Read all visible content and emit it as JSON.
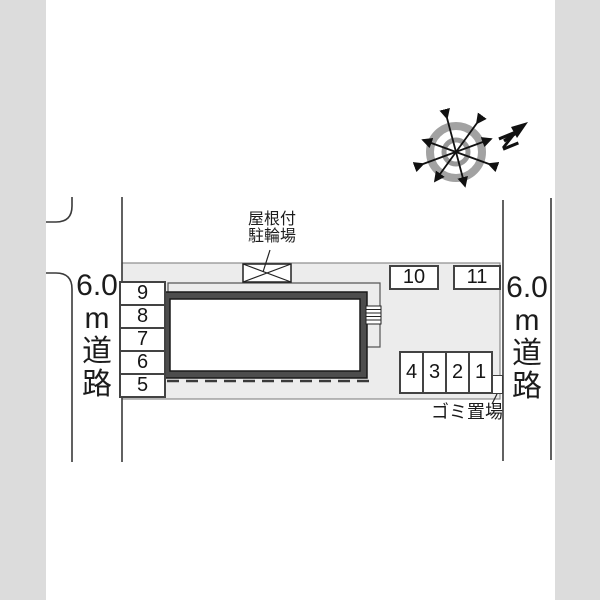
{
  "plan": {
    "roads": {
      "left": {
        "label": "6.0m道路",
        "lines": [
          "6.0",
          "m",
          "道",
          "路"
        ]
      },
      "right": {
        "label": "6.0m道路",
        "lines": [
          "6.0",
          "m",
          "道",
          "路"
        ]
      }
    },
    "bicycle_parking": {
      "label_line1": "屋根付",
      "label_line2": "駐輪場"
    },
    "garbage": {
      "label": "ゴミ置場"
    },
    "compass": {
      "north_label": "N"
    },
    "parking_spaces": {
      "left_column": [
        "9",
        "8",
        "7",
        "6",
        "5"
      ],
      "top_row": [
        "10",
        "11"
      ],
      "bottom_row": [
        "4",
        "3",
        "2",
        "1"
      ]
    }
  },
  "colors": {
    "offsite_gray": "#dcdcdc",
    "lot_fill": "#ececec",
    "lot_border": "#8c8c8c",
    "line_dark": "#3a3a3a",
    "building_wall": "#4d4d4d",
    "compass_ring": "#a2a2a2"
  }
}
